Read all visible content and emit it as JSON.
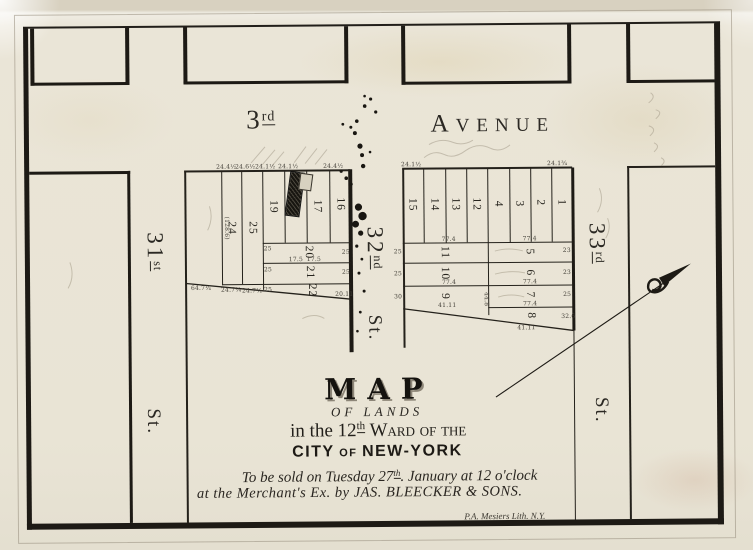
{
  "streets": {
    "avenue": {
      "number": "3",
      "suffix": "rd",
      "name_initial": "A",
      "name_rest": "VENUE"
    },
    "s31": {
      "number": "31",
      "suffix": "st",
      "st": "St."
    },
    "s32": {
      "number": "32",
      "suffix": "nd",
      "st": "St."
    },
    "s33": {
      "number": "33",
      "suffix": "rd",
      "st": "St."
    }
  },
  "title_block": {
    "map": "MAP",
    "of_lands": "OF LANDS",
    "ward_line": {
      "pre": "in the ",
      "num": "12",
      "sup": "th",
      "post": " Ward of the"
    },
    "city_line": {
      "a": "CITY",
      "of": " OF ",
      "b": "NEW-YORK"
    },
    "sale_line1": {
      "pre": "To be sold on Tuesday 27",
      "sup": "th",
      "post": ". January at 12 o'clock"
    },
    "sale_line2": "at the Merchant's Ex. by JAS. BLEECKER & SONS.",
    "imprint": "P.A. Mesiers Lith. N.Y."
  },
  "left_block": {
    "lots": [
      {
        "n": "24",
        "x": 232,
        "y": 227
      },
      {
        "n": "25",
        "x": 253,
        "y": 227
      },
      {
        "n": "19",
        "x": 274,
        "y": 206
      },
      {
        "n": "17",
        "x": 318,
        "y": 206
      },
      {
        "n": "16",
        "x": 341,
        "y": 204
      },
      {
        "n": "20",
        "x": 309,
        "y": 252
      },
      {
        "n": "21",
        "x": 310,
        "y": 272
      },
      {
        "n": "22",
        "x": 312,
        "y": 290
      }
    ]
  },
  "right_block": {
    "lots": [
      {
        "n": "15",
        "x": 413,
        "y": 205
      },
      {
        "n": "14",
        "x": 435,
        "y": 205
      },
      {
        "n": "13",
        "x": 456,
        "y": 205
      },
      {
        "n": "12",
        "x": 477,
        "y": 205
      },
      {
        "n": "4",
        "x": 499,
        "y": 205
      },
      {
        "n": "3",
        "x": 520,
        "y": 205
      },
      {
        "n": "2",
        "x": 541,
        "y": 204
      },
      {
        "n": "1",
        "x": 562,
        "y": 204
      },
      {
        "n": "11",
        "x": 445,
        "y": 253
      },
      {
        "n": "10",
        "x": 445,
        "y": 274
      },
      {
        "n": "9",
        "x": 445,
        "y": 297
      },
      {
        "n": "5",
        "x": 530,
        "y": 253
      },
      {
        "n": "6",
        "x": 530,
        "y": 274
      },
      {
        "n": "7",
        "x": 530,
        "y": 296
      },
      {
        "n": "8",
        "x": 531,
        "y": 317
      }
    ]
  },
  "dimensions": [
    {
      "t": "24.4½",
      "x": 227,
      "y": 166
    },
    {
      "t": "24.6½",
      "x": 246,
      "y": 166
    },
    {
      "t": "24.1½",
      "x": 266,
      "y": 166
    },
    {
      "t": "24.1½",
      "x": 289,
      "y": 166
    },
    {
      "t": "24.4½",
      "x": 334,
      "y": 166
    },
    {
      "t": "64.7¼",
      "x": 201,
      "y": 287
    },
    {
      "t": "24.7¼",
      "x": 231,
      "y": 289
    },
    {
      "t": "24.7½",
      "x": 252,
      "y": 290
    },
    {
      "t": "(128.6)",
      "x": 227,
      "y": 227,
      "r": 1
    },
    {
      "t": "25",
      "x": 268,
      "y": 248
    },
    {
      "t": "25",
      "x": 268,
      "y": 269
    },
    {
      "t": "25",
      "x": 268,
      "y": 289
    },
    {
      "t": "25",
      "x": 346,
      "y": 252
    },
    {
      "t": "25",
      "x": 346,
      "y": 272
    },
    {
      "t": "20.11",
      "x": 344,
      "y": 294
    },
    {
      "t": "17.5",
      "x": 296,
      "y": 259
    },
    {
      "t": "17.5",
      "x": 314,
      "y": 259
    },
    {
      "t": "24.1½",
      "x": 412,
      "y": 165
    },
    {
      "t": "24.1¾",
      "x": 558,
      "y": 165
    },
    {
      "t": "77.4",
      "x": 449,
      "y": 240
    },
    {
      "t": "77.4",
      "x": 530,
      "y": 240
    },
    {
      "t": "77.4",
      "x": 449,
      "y": 283
    },
    {
      "t": "77.4",
      "x": 530,
      "y": 283
    },
    {
      "t": "41.11",
      "x": 447,
      "y": 306
    },
    {
      "t": "77.4",
      "x": 530,
      "y": 305
    },
    {
      "t": "44.8",
      "x": 486,
      "y": 300,
      "r": 1
    },
    {
      "t": "41.11",
      "x": 526,
      "y": 329
    },
    {
      "t": "25",
      "x": 398,
      "y": 252
    },
    {
      "t": "25",
      "x": 398,
      "y": 274
    },
    {
      "t": "30",
      "x": 398,
      "y": 297
    },
    {
      "t": "23",
      "x": 567,
      "y": 252
    },
    {
      "t": "23",
      "x": 567,
      "y": 274
    },
    {
      "t": "25",
      "x": 567,
      "y": 296
    },
    {
      "t": "32.6",
      "x": 568,
      "y": 318
    }
  ],
  "colors": {
    "paper": "#e9e4d5",
    "ink": "#1d1a15",
    "pencil": "#a69d8b"
  }
}
